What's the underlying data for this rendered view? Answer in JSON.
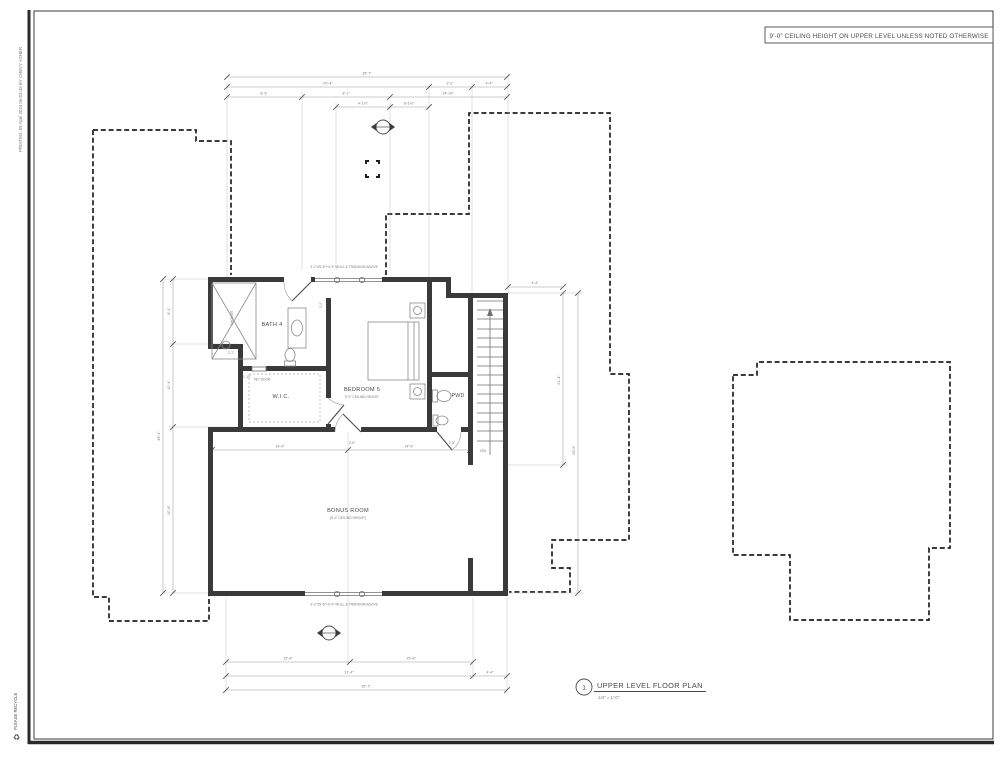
{
  "page": {
    "ceiling_note": "9'-0\" CEILING HEIGHT ON UPPER LEVEL UNLESS NOTED OTHERWISE",
    "printed_stamp": "PRINTED: 09 April 2024 06:03:45 BY CHEVY ASHER",
    "recycle_note": "PLEASE RECYCLE",
    "recycle_icon": "♻"
  },
  "title_block": {
    "sheet_number": "1",
    "title": "UPPER LEVEL FLOOR PLAN",
    "scale": "1/4\" = 1'-0\""
  },
  "rooms": {
    "bath4": "BATH 4",
    "wic": "W.I.C.",
    "bedroom5": "BEDROOM 5",
    "bedroom5_note": "9'-0\" CEILING HEIGHT",
    "pwd": "PWD",
    "bonus": "BONUS ROOM",
    "bonus_note": "(9'-0\" CEILING HEIGHT)",
    "shower": "SHOWER"
  },
  "annotations": {
    "window_top": "3'-2\"X5'-6\"+4'-9\" MULL & TRANSOM ABOVE",
    "window_bottom": "3'-2\"X5'-6\"+4'-9\" MULL & TRANSOM ABOVE",
    "pet_door": "PET DOOR",
    "down": "DN"
  },
  "dims": {
    "top": {
      "overall": "35'-7\"",
      "row2": [
        "20'-4\"",
        "3'-2\"",
        "4'-4\""
      ],
      "row3": [
        "8'-3\"",
        "8'-1\"",
        "14'-10\""
      ],
      "row4": [
        "4'-1½\"",
        "8'-1½\""
      ]
    },
    "bottom": {
      "row1": [
        "15'-8\"",
        "15'-8\""
      ],
      "row2": [
        "31'-4\"",
        "4'-4\""
      ],
      "overall": "35'-7\""
    },
    "left": {
      "overall": "39'-1\"",
      "segments": [
        "8'-1\"",
        "10'-4\"",
        "20'-8\""
      ]
    },
    "right": {
      "top": "4'-4\"",
      "inner": "21'-4\"",
      "outer": "29'-6\""
    },
    "interior": [
      "2'-7\"",
      "1'-10\"",
      "2'-2\"",
      "2'-8\"",
      "2'-8\"",
      "14'-0\"",
      "14'-6\""
    ]
  }
}
